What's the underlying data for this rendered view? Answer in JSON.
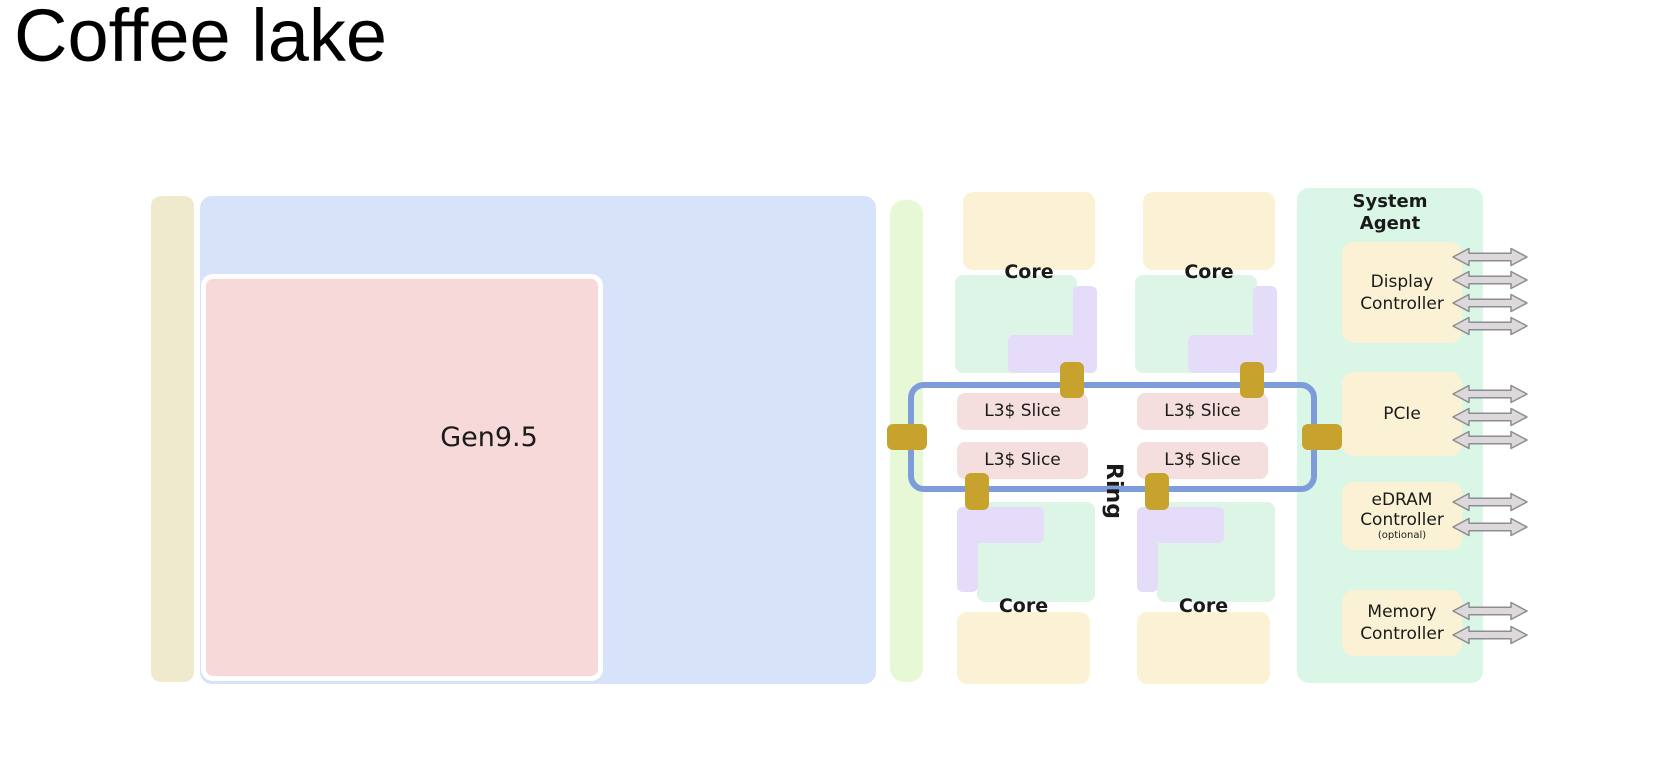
{
  "page_title": "Coffee lake",
  "labels": {
    "gpu": "Gen9.5",
    "core": "Core",
    "l3_slice": "L3$ Slice",
    "ring": "Ring"
  },
  "system_agent": {
    "title_line1": "System",
    "title_line2": "Agent",
    "display": {
      "line1": "Display",
      "line2": "Controller",
      "arrows": 4
    },
    "pcie": {
      "line1": "PCIe",
      "arrows": 3
    },
    "edram": {
      "line1": "eDRAM",
      "line2": "Controller",
      "note": "(optional)",
      "arrows": 2
    },
    "memory": {
      "line1": "Memory",
      "line2": "Controller",
      "arrows": 2
    }
  },
  "colors": {
    "beige_strip": "#efe9ce",
    "gpu_outer_blue": "#d7e3f8",
    "gen95_pink": "#f8d9d9",
    "green_strip": "#e7f8d6",
    "core_cream": "#fbf2d6",
    "core_mint": "#dcf5e7",
    "uncore_purple": "#e5dcf9",
    "l3_pink": "#f5dede",
    "ring_blue": "#7d9cd9",
    "interconnect_gold": "#c7a22d",
    "system_agent_mint": "#d9f6e6",
    "io_cream": "#fbf2d6",
    "arrow_fill": "#dcd8dc",
    "arrow_stroke": "#8d8d8d",
    "text": "#1a1a1a"
  }
}
